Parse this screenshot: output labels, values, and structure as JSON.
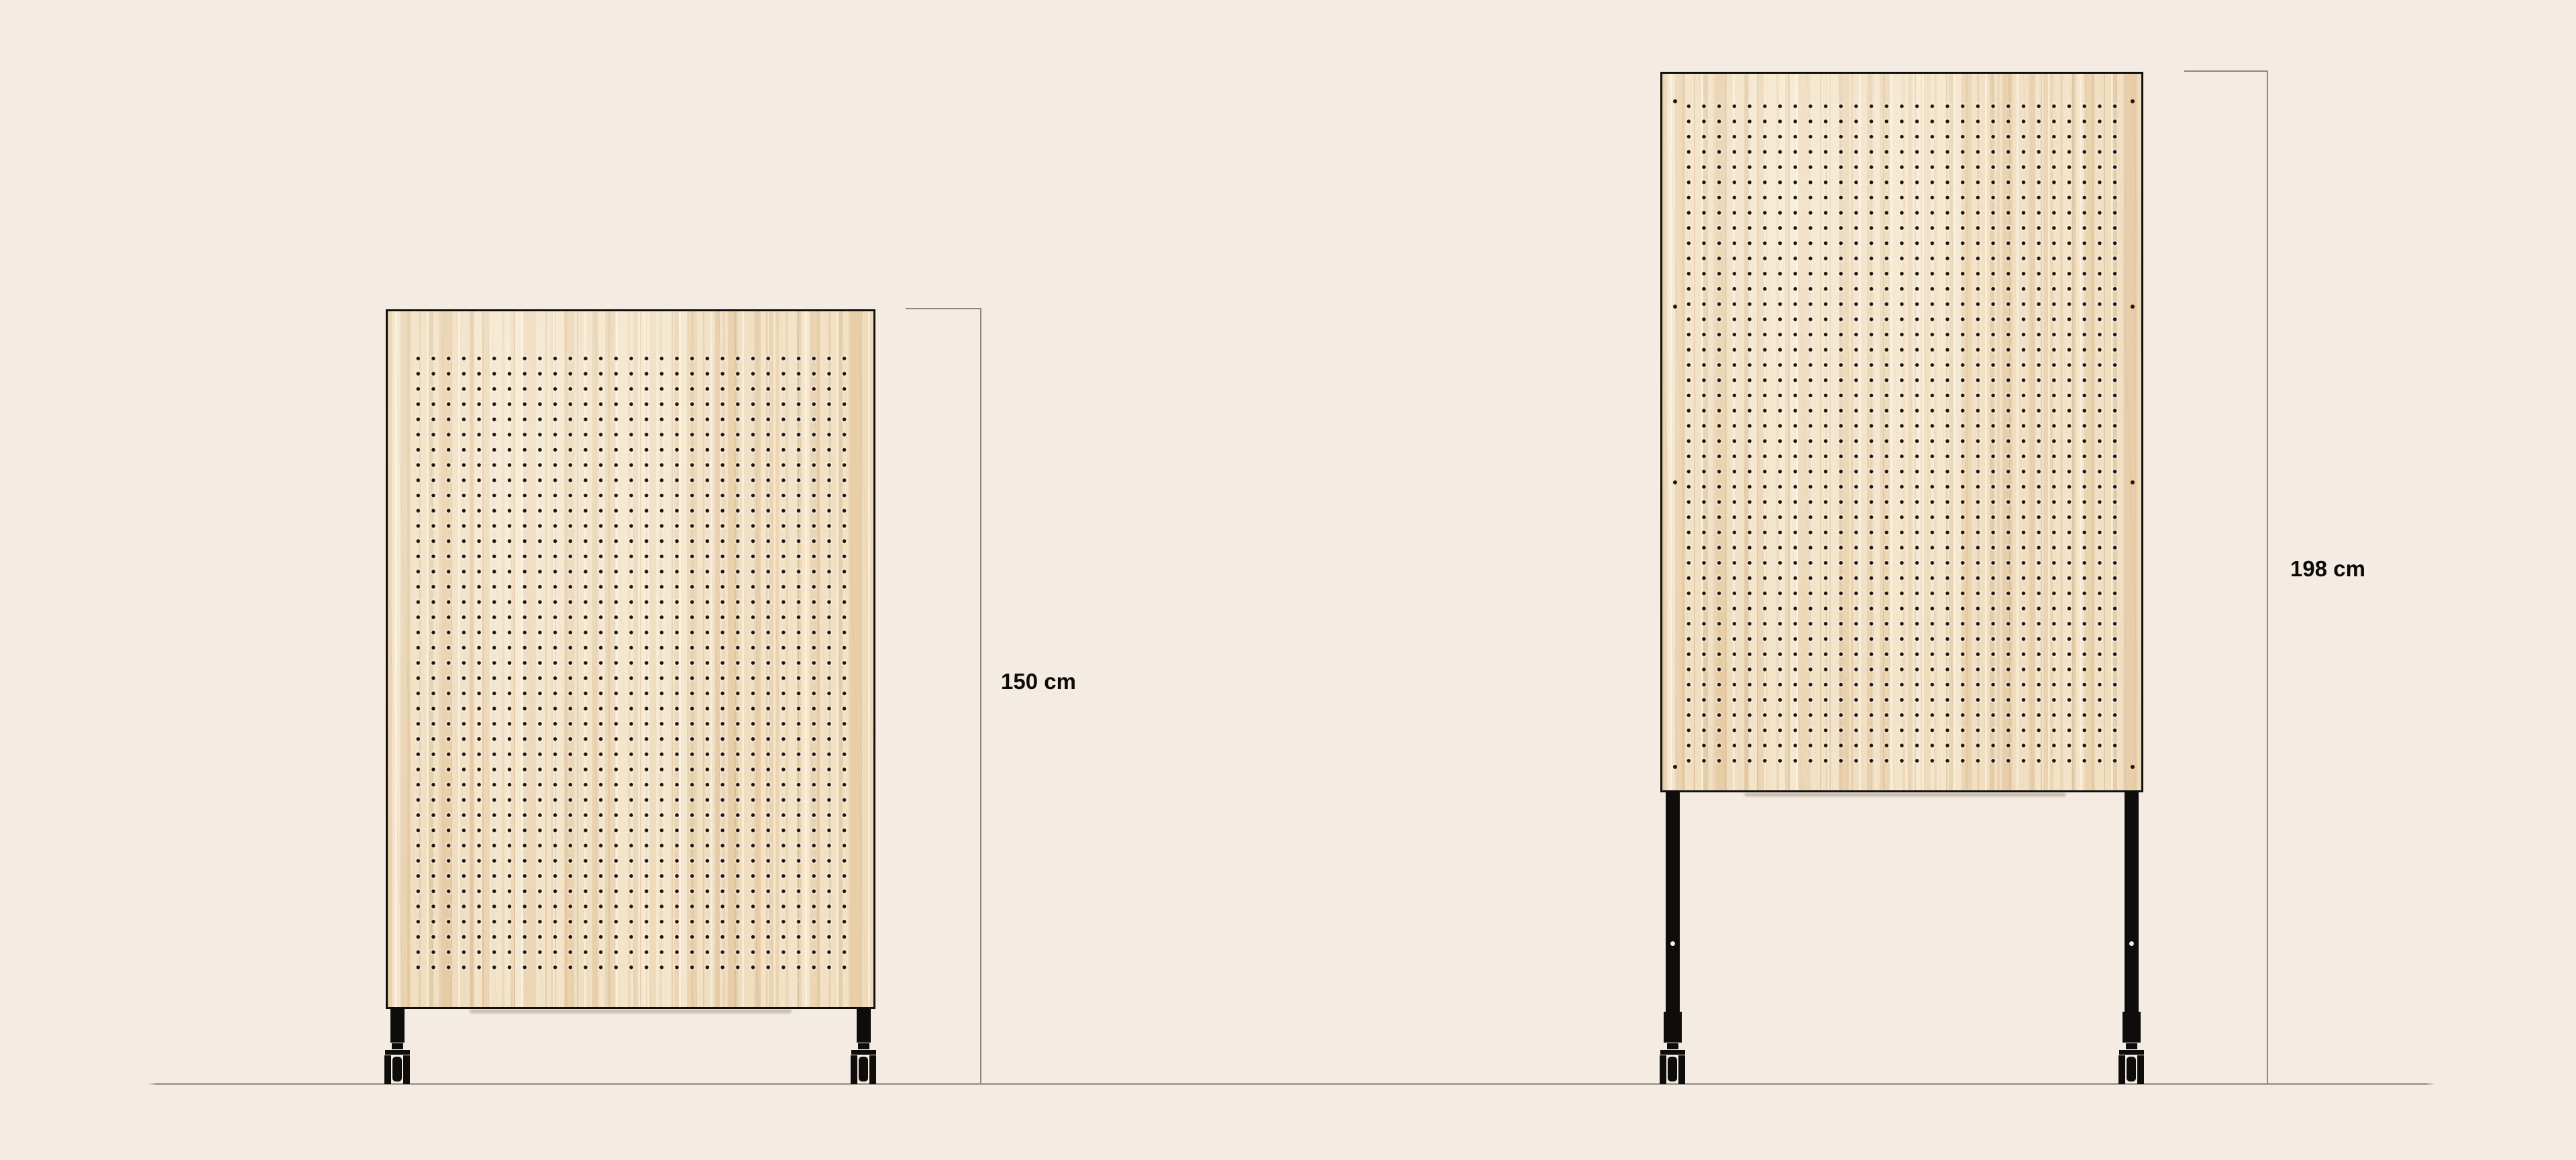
{
  "scene": {
    "description_labels": [],
    "background_color": "#f4ece3",
    "ground_line_color": "#a8a19a",
    "dimension_line_color": "#8d8780",
    "label_text_color": "#0b0a09",
    "wood_base_color": "#eed9bb",
    "frame_color": "#12100e",
    "peg_hole_color": "#1c130c"
  },
  "panels": [
    {
      "side": "left",
      "dimension_label": "150 cm"
    },
    {
      "side": "right",
      "dimension_label": "198 cm"
    }
  ]
}
